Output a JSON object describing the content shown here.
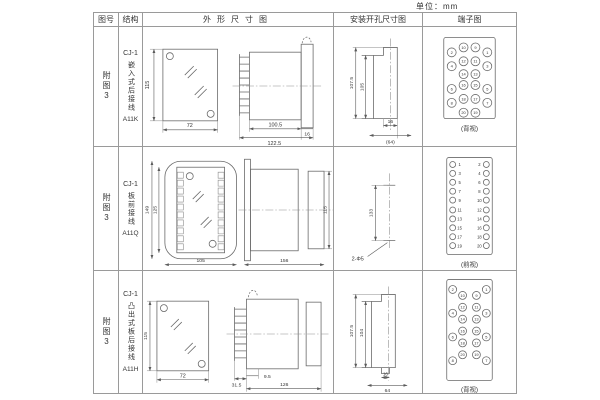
{
  "units_label": "单位：mm",
  "headers": {
    "fig_no": "图号",
    "structure": "结构",
    "outline": "外形尺寸图",
    "install": "安装开孔尺寸图",
    "terminal": "端子图"
  },
  "rows": [
    {
      "fig_no": "附图3",
      "structure": {
        "model": "CJ-1",
        "desc": "嵌入式后接线",
        "code": "A11K"
      },
      "outline": {
        "height": "115",
        "width": "72",
        "depth_body": "100.5",
        "depth_total": "122.5",
        "flange_depth": "16"
      },
      "install": {
        "outer_height": "107.5",
        "inner_height": "105",
        "slot_width": "16",
        "panel_width": "(64)"
      },
      "terminal": {
        "numbers": [
          "2",
          "10",
          "9",
          "1",
          "4",
          "12",
          "11",
          "3",
          "14",
          "13",
          "6",
          "16",
          "15",
          "5",
          "8",
          "18",
          "17",
          "7",
          "20",
          "19"
        ],
        "caption": "(背视)"
      }
    },
    {
      "fig_no": "附图3",
      "structure": {
        "model": "CJ-1",
        "desc": "板前接线",
        "code": "A11Q"
      },
      "outline": {
        "outer_height": "149",
        "inner_height": "125",
        "width": "105",
        "depth": "156",
        "body_height": "115"
      },
      "install": {
        "hole_pitch": "133",
        "hole_label": "2-Φ5"
      },
      "terminal": {
        "left": [
          "1",
          "3",
          "5",
          "7",
          "9",
          "11",
          "13",
          "15",
          "17",
          "19"
        ],
        "right": [
          "2",
          "4",
          "6",
          "8",
          "10",
          "12",
          "14",
          "16",
          "18",
          "20"
        ],
        "caption": "(前视)"
      }
    },
    {
      "fig_no": "附图3",
      "structure": {
        "model": "CJ-1",
        "desc": "凸出式板后接线",
        "code": "A11H"
      },
      "outline": {
        "height": "115",
        "width": "72",
        "pin_depth": "31.5",
        "front_depth": "9.5",
        "depth": "126"
      },
      "install": {
        "outer_height": "107.5",
        "inner_height": "104",
        "slot_width": "16",
        "panel_width": "64"
      },
      "terminal": {
        "left_outer": [
          "2",
          "4",
          "6",
          "8"
        ],
        "left_inner": [
          "10",
          "12",
          "14",
          "16",
          "18",
          "20"
        ],
        "right_outer": [
          "1",
          "3",
          "5",
          "7"
        ],
        "right_inner": [
          "9",
          "11",
          "13",
          "15",
          "17",
          "19"
        ],
        "caption": "(背视)"
      }
    }
  ]
}
